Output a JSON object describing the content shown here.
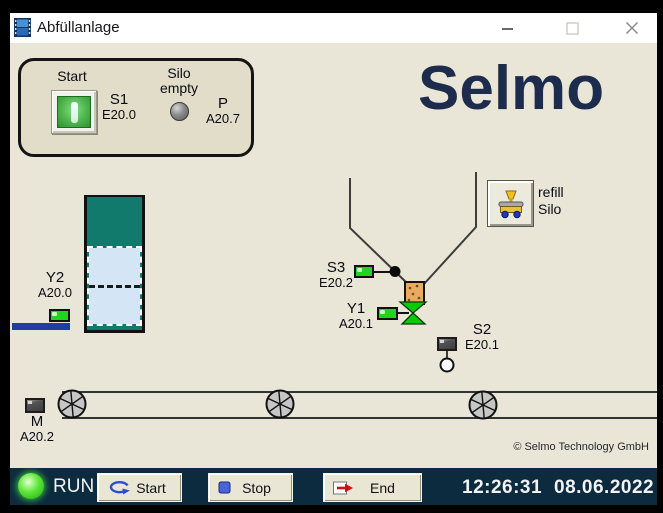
{
  "titlebar": {
    "title": "Abfüllanlage"
  },
  "logo": {
    "text": "Selmo"
  },
  "control_panel": {
    "start_label": "Start",
    "s1": {
      "name": "S1",
      "address": "E20.0"
    },
    "silo_empty_line1": "Silo",
    "silo_empty_line2": "empty",
    "p": {
      "name": "P",
      "address": "A20.7"
    }
  },
  "silo": {
    "y2": {
      "name": "Y2",
      "address": "A20.0"
    }
  },
  "hopper": {
    "s3": {
      "name": "S3",
      "address": "E20.2"
    },
    "y1": {
      "name": "Y1",
      "address": "A20.1"
    },
    "s2": {
      "name": "S2",
      "address": "E20.1"
    },
    "refill": {
      "line1": "refill",
      "line2": "Silo"
    }
  },
  "conveyor": {
    "m": {
      "name": "M",
      "address": "A20.2"
    }
  },
  "footer": {
    "status": "RUN",
    "start": "Start",
    "stop": "Stop",
    "end": "End",
    "time": "12:26:31",
    "date": "08.06.2022"
  },
  "copyright": "© Selmo Technology GmbH",
  "colors": {
    "accent_navy": "#1d2c4c",
    "footer_bg": "#0d2b3f",
    "silo_teal": "#127a6d",
    "indicator_green": "#1ed61e",
    "valve_green": "#05cc05",
    "tube_orange": "#e9a95e",
    "level_blue": "#d4e6f5",
    "bar_blue": "#1d3f9e"
  }
}
